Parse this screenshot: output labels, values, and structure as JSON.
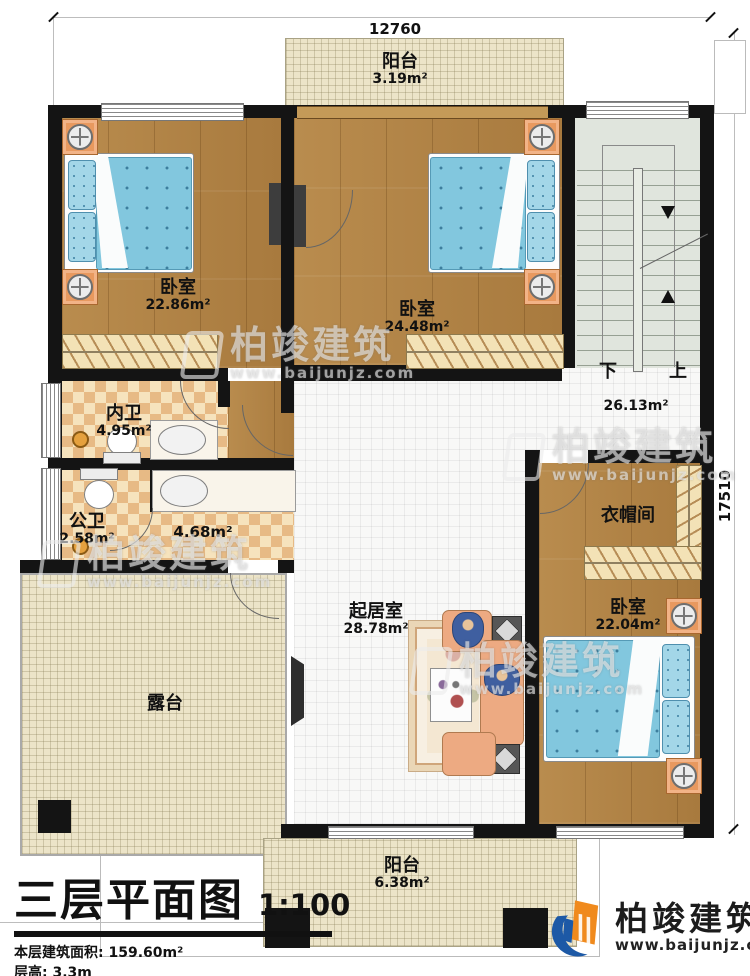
{
  "drawing": {
    "title": "三层平面图",
    "scale": "1:100",
    "area_line": "本层建筑面积: 159.60m²",
    "height_line": "层高: 3.3m"
  },
  "dimensions": {
    "width": "12760",
    "height": "17510"
  },
  "rooms": {
    "balcony_top": {
      "name": "阳台",
      "area": "3.19m²"
    },
    "bedroom_left": {
      "name": "卧室",
      "area": "22.86m²"
    },
    "bedroom_mid": {
      "name": "卧室",
      "area": "24.48m²"
    },
    "bedroom_right": {
      "name": "卧室",
      "area": "22.04m²"
    },
    "ensuite_bath": {
      "name": "内卫",
      "area": "4.95m²"
    },
    "public_bath": {
      "name": "公卫",
      "area": "2.58m²"
    },
    "wash_area": {
      "area": "4.68m²"
    },
    "living": {
      "name": "起居室",
      "area": "28.78m²"
    },
    "cloakroom": {
      "name": "衣帽间"
    },
    "terrace": {
      "name": "露台"
    },
    "balcony_bottom": {
      "name": "阳台",
      "area": "6.38m²"
    }
  },
  "stairs": {
    "down": "下",
    "up": "上",
    "area": "26.13m²"
  },
  "brand": {
    "name": "柏竣建筑",
    "url": "www.baijunjz.com"
  },
  "watermark": {
    "name": "柏竣建筑",
    "url": "www.baijunjz.com"
  },
  "colors": {
    "wall": "#141414",
    "wood": "#b28347",
    "tile_dark": "#e7ba85",
    "tile_light": "#f6e3bd",
    "balcony": "#ece4c8",
    "stairs": "#e0e5dd",
    "bed": "#82c7de",
    "nightstand": "#e8995f",
    "sofa": "#edaa82",
    "logo_blue": "#1d59a6",
    "logo_orange": "#f08a1d"
  }
}
